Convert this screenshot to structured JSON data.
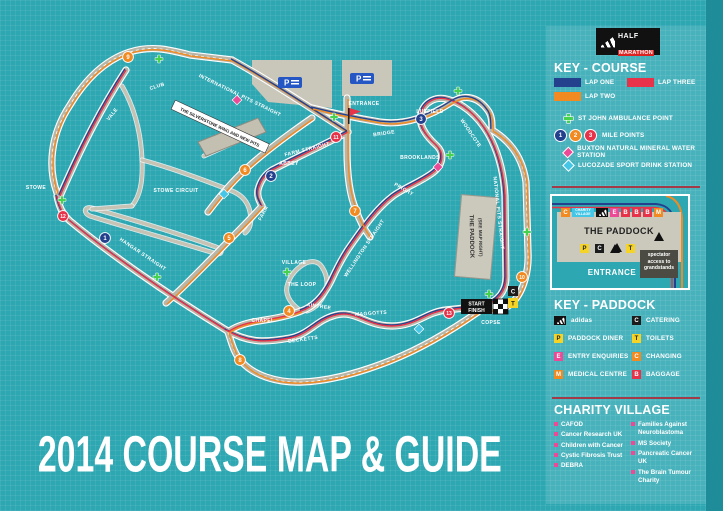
{
  "title": "2014 COURSE MAP & GUIDE",
  "logo": {
    "brand": "adidas",
    "event_line1": "HALF",
    "event_line2": "MARATHON"
  },
  "colors": {
    "blue": "#24418e",
    "orange": "#f18a21",
    "red": "#e6334a",
    "green": "#46d24e",
    "pink": "#ec4a96",
    "cyan": "#45c6e6",
    "yellow": "#f5d327",
    "black": "#1c1c1c",
    "teal": "#2da7b2"
  },
  "key_course": {
    "heading": "KEY - COURSE",
    "laps": [
      {
        "label": "LAP ONE",
        "color": "#24418e"
      },
      {
        "label": "LAP THREE",
        "color": "#e6334a"
      },
      {
        "label": "LAP TWO",
        "color": "#f18a21"
      }
    ],
    "ambulance_label": "ST JOHN AMBULANCE POINT",
    "mile_points_label": "MILE POINTS",
    "mile_point_samples": [
      {
        "n": "1",
        "color": "#24418e"
      },
      {
        "n": "2",
        "color": "#f18a21"
      },
      {
        "n": "3",
        "color": "#e6334a"
      }
    ],
    "water_label": "BUXTON NATURAL MINERAL WATER STATION",
    "drink_label": "LUCOZADE SPORT DRINK STATION"
  },
  "paddock_inset": {
    "title": "THE PADDOCK",
    "entrance_label": "ENTRANCE",
    "spectator_note": "spectator access to grandstands",
    "top_icons": [
      {
        "letter": "C",
        "color": "#f18a21"
      },
      {
        "label": "CHARITY VILLAGE",
        "color": "#45c6e6",
        "type": "wide"
      },
      {
        "type": "adidas"
      },
      {
        "letter": "E",
        "color": "#ec4a96"
      },
      {
        "letter": "B",
        "color": "#e6334a"
      },
      {
        "letter": "B",
        "color": "#e6334a"
      },
      {
        "letter": "B",
        "color": "#e6334a"
      },
      {
        "letter": "M",
        "color": "#f18a21"
      }
    ],
    "bottom_icons": [
      {
        "letter": "P",
        "color": "#f5d327",
        "dark": true
      },
      {
        "letter": "C",
        "color": "#1c1c1c"
      },
      {
        "type": "arrow"
      },
      {
        "letter": "T",
        "color": "#f5d327",
        "dark": true
      }
    ]
  },
  "key_paddock": {
    "heading": "KEY - PADDOCK",
    "left": [
      {
        "icon": "adidas",
        "label": "adidas"
      },
      {
        "letter": "P",
        "color": "#f5d327",
        "dark": true,
        "label": "PADDOCK DINER"
      },
      {
        "letter": "E",
        "color": "#ec4a96",
        "label": "ENTRY ENQUIRIES"
      },
      {
        "letter": "M",
        "color": "#f18a21",
        "label": "MEDICAL CENTRE"
      }
    ],
    "right": [
      {
        "letter": "C",
        "color": "#1c1c1c",
        "label": "CATERING"
      },
      {
        "letter": "T",
        "color": "#f5d327",
        "dark": true,
        "label": "TOILETS"
      },
      {
        "letter": "C",
        "color": "#f18a21",
        "label": "CHANGING"
      },
      {
        "letter": "B",
        "color": "#e6334a",
        "label": "BAGGAGE"
      }
    ]
  },
  "charity_village": {
    "heading": "CHARITY VILLAGE",
    "left": [
      "CAFOD",
      "Cancer Research UK",
      "Children with Cancer",
      "Cystic Fibrosis Trust",
      "DEBRA"
    ],
    "right": [
      "Families Against Neuroblastoma",
      "MS Society",
      "Pancreatic Cancer UK",
      "The Brain Tumour Charity"
    ]
  },
  "map": {
    "labels": [
      {
        "t": "STOWE",
        "x": 36,
        "y": 187,
        "r": 0
      },
      {
        "t": "VALE",
        "x": 112,
        "y": 114,
        "r": -52
      },
      {
        "t": "CLUB",
        "x": 157,
        "y": 86,
        "r": -18
      },
      {
        "t": "INTERNATIONAL PITS STRAIGHT",
        "x": 240,
        "y": 95,
        "r": 26
      },
      {
        "t": "THE SILVERSTONE WING AND NEW PITS",
        "x": 220,
        "y": 127,
        "r": 25,
        "boxed": true
      },
      {
        "t": "STOWE CIRCUIT",
        "x": 176,
        "y": 190,
        "r": 0
      },
      {
        "t": "FARM STRAIGHT",
        "x": 307,
        "y": 149,
        "r": -14
      },
      {
        "t": "FARM",
        "x": 263,
        "y": 213,
        "r": -62
      },
      {
        "t": "ABBEY",
        "x": 289,
        "y": 163,
        "r": 0
      },
      {
        "t": "BRIDGE",
        "x": 384,
        "y": 133,
        "r": -8
      },
      {
        "t": "LUFFIELD",
        "x": 430,
        "y": 111,
        "r": 0
      },
      {
        "t": "WOODCOTE",
        "x": 471,
        "y": 133,
        "r": 56
      },
      {
        "t": "BROOKLANDS",
        "x": 420,
        "y": 157,
        "r": 0
      },
      {
        "t": "PRIORY",
        "x": 404,
        "y": 189,
        "r": 30
      },
      {
        "t": "HANGAR STRAIGHT",
        "x": 143,
        "y": 254,
        "r": 34
      },
      {
        "t": "WELLINGTON STRAIGHT",
        "x": 364,
        "y": 248,
        "r": -56
      },
      {
        "t": "VILLAGE",
        "x": 294,
        "y": 262,
        "r": 0
      },
      {
        "t": "THE LOOP",
        "x": 302,
        "y": 284,
        "r": 0
      },
      {
        "t": "AINTREE",
        "x": 319,
        "y": 306,
        "r": 8
      },
      {
        "t": "CHAPEL",
        "x": 263,
        "y": 320,
        "r": 0
      },
      {
        "t": "MAGGOTTS",
        "x": 371,
        "y": 313,
        "r": -4
      },
      {
        "t": "BECKETTS",
        "x": 303,
        "y": 339,
        "r": -8
      },
      {
        "t": "COPSE",
        "x": 491,
        "y": 322,
        "r": 0
      },
      {
        "t": "NATIONAL PITS STRAIGHT",
        "x": 499,
        "y": 213,
        "r": 84
      },
      {
        "t": "ENTRANCE",
        "x": 364,
        "y": 103,
        "r": 0
      }
    ],
    "mile_points": [
      {
        "n": "1",
        "x": 105,
        "y": 238,
        "c": "blue"
      },
      {
        "n": "2",
        "x": 271,
        "y": 176,
        "c": "blue"
      },
      {
        "n": "3",
        "x": 421,
        "y": 119,
        "c": "blue"
      },
      {
        "n": "4",
        "x": 289,
        "y": 311,
        "c": "orange"
      },
      {
        "n": "5",
        "x": 229,
        "y": 238,
        "c": "orange"
      },
      {
        "n": "6",
        "x": 245,
        "y": 170,
        "c": "orange"
      },
      {
        "n": "7",
        "x": 355,
        "y": 211,
        "c": "orange"
      },
      {
        "n": "8",
        "x": 240,
        "y": 360,
        "c": "orange"
      },
      {
        "n": "9",
        "x": 128,
        "y": 57,
        "c": "orange"
      },
      {
        "n": "10",
        "x": 522,
        "y": 277,
        "c": "orange"
      },
      {
        "n": "11",
        "x": 336,
        "y": 137,
        "c": "red"
      },
      {
        "n": "12",
        "x": 63,
        "y": 216,
        "c": "red"
      },
      {
        "n": "13",
        "x": 449,
        "y": 313,
        "c": "red"
      }
    ],
    "ambulance_points": [
      {
        "x": 159,
        "y": 59
      },
      {
        "x": 62,
        "y": 200
      },
      {
        "x": 157,
        "y": 277
      },
      {
        "x": 287,
        "y": 272
      },
      {
        "x": 334,
        "y": 117
      },
      {
        "x": 458,
        "y": 91
      },
      {
        "x": 450,
        "y": 155
      },
      {
        "x": 527,
        "y": 232
      },
      {
        "x": 489,
        "y": 294
      }
    ],
    "water_stations": [
      {
        "x": 237,
        "y": 100
      },
      {
        "x": 438,
        "y": 167
      }
    ],
    "drink_stations": [
      {
        "x": 224,
        "y": 194
      },
      {
        "x": 419,
        "y": 329
      }
    ],
    "start_finish": {
      "line1": "START",
      "line2": "FINISH"
    },
    "start_facilities": {
      "catering": "C",
      "toilets": "T"
    },
    "parking_label": "P",
    "paddock_building": {
      "line1": "THE PADDOCK",
      "line2": "(SEE MAP RIGHT)"
    }
  }
}
